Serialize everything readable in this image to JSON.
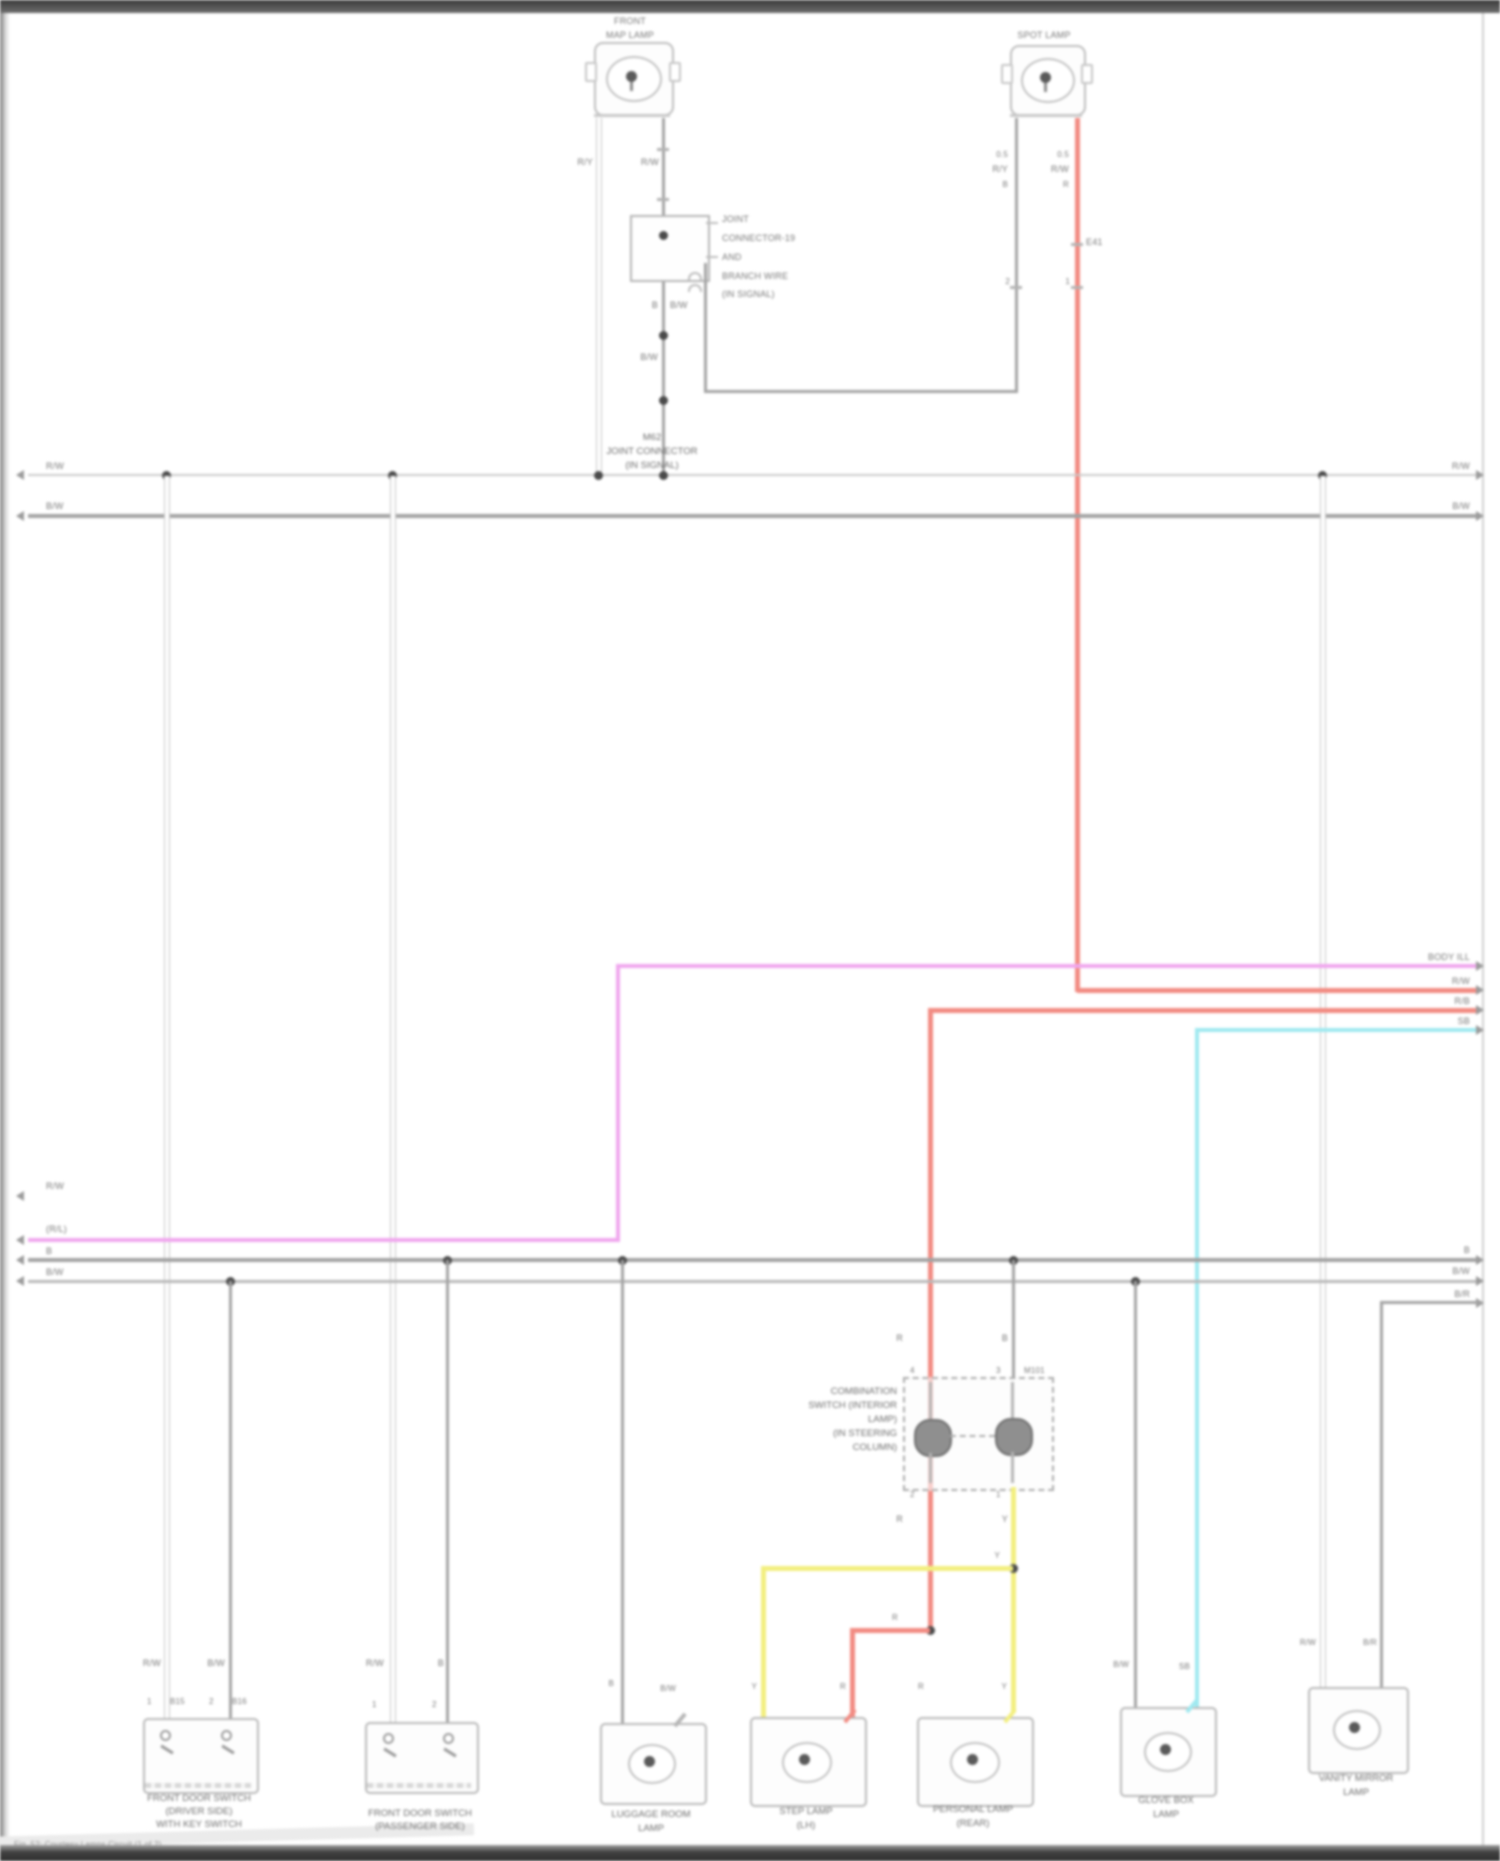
{
  "colors": {
    "wire_gray": "#a3a3a3",
    "wire_outlined_white": "#ffffff",
    "wire_pink": "#f0a6ee",
    "wire_red": "#f28b82",
    "wire_yellow": "#f3ef7e",
    "wire_cyan": "#9fe9f0",
    "junction_dot": "#4a4a4a",
    "page_bar": "#3a3a3a"
  },
  "lamps": {
    "map_lamp": {
      "line1": "FRONT",
      "line2": "MAP LAMP",
      "w1": "R/Y",
      "w2": "R/W"
    },
    "spot_lamp": {
      "label": "SPOT LAMP",
      "w1a": "0.5",
      "w1b": "R/Y",
      "w1c": "B",
      "w2a": "0.5",
      "w2b": "R/W",
      "w2c": "R",
      "pin1": "2",
      "pin2": "1",
      "tick": "E41"
    }
  },
  "joint_note": {
    "l1": "JOINT",
    "l2": "CONNECTOR-19",
    "l3": "AND",
    "l4": "BRANCH WIRE",
    "l5": "(IN SIGNAL)"
  },
  "joint_caption": {
    "l1": "M62",
    "l2": "JOINT CONNECTOR",
    "l3": "(IN SIGNAL)"
  },
  "joint_pins": {
    "w1": "B",
    "w2": "B/W",
    "mid": "B/W"
  },
  "bus": {
    "top1_left": "R/W",
    "top1_right": "R/W",
    "top2_left": "B/W",
    "top2_right": "B/W",
    "low_float_left": "R/W",
    "pink_left": "(R/L)",
    "pink_right": "BODY ILL",
    "red1_right": "R/W",
    "red2_right": "R/B",
    "cyan_right": "SB",
    "lowA_left": "B",
    "lowA_right": "B",
    "lowB_left": "B/W",
    "lowB_right": "B/W",
    "stub_right": "B/R"
  },
  "switch": {
    "caption": [
      "COMBINATION",
      "SWITCH (INTERIOR",
      "LAMP)",
      "(IN STEERING",
      "COLUMN)"
    ],
    "top_w1": "R",
    "top_w2": "B",
    "top_p1": "4",
    "top_p2": "3",
    "top_conn": "M101",
    "bot_p1": "2",
    "bot_p2": "1",
    "bot_w1": "R",
    "bot_w2": "Y",
    "red_jog": "R",
    "yellow_jct": "Y"
  },
  "comps": {
    "c1": {
      "codes": [
        "R/W",
        "B/W"
      ],
      "pins": [
        "1",
        "B15",
        "2",
        "B16"
      ],
      "caption": [
        "FRONT DOOR SWITCH",
        "(DRIVER SIDE)",
        "WITH KEY SWITCH"
      ]
    },
    "c2": {
      "codes": [
        "R/W",
        "B"
      ],
      "pins": [
        "1",
        "2"
      ],
      "caption": [
        "FRONT DOOR SWITCH",
        "(PASSENGER SIDE)"
      ]
    },
    "c3": {
      "codes": [
        "B",
        "B/W"
      ],
      "caption": [
        "LUGGAGE ROOM",
        "LAMP"
      ]
    },
    "c4": {
      "codes": [
        "Y",
        "R"
      ],
      "caption": [
        "STEP LAMP",
        "(LH)"
      ]
    },
    "c5": {
      "codes": [
        "R",
        "Y"
      ],
      "caption": [
        "PERSONAL LAMP",
        "(REAR)"
      ]
    },
    "c6": {
      "codes": [
        "B/W",
        "SB"
      ],
      "caption": [
        "GLOVE BOX",
        "LAMP"
      ]
    },
    "c7": {
      "codes": [
        "R/W",
        "B/R"
      ],
      "caption": [
        "VANITY MIRROR",
        "LAMP"
      ]
    }
  },
  "footer": {
    "note": "Fig. 52: Courtesy Lamps Circuit (1 of 2)"
  }
}
